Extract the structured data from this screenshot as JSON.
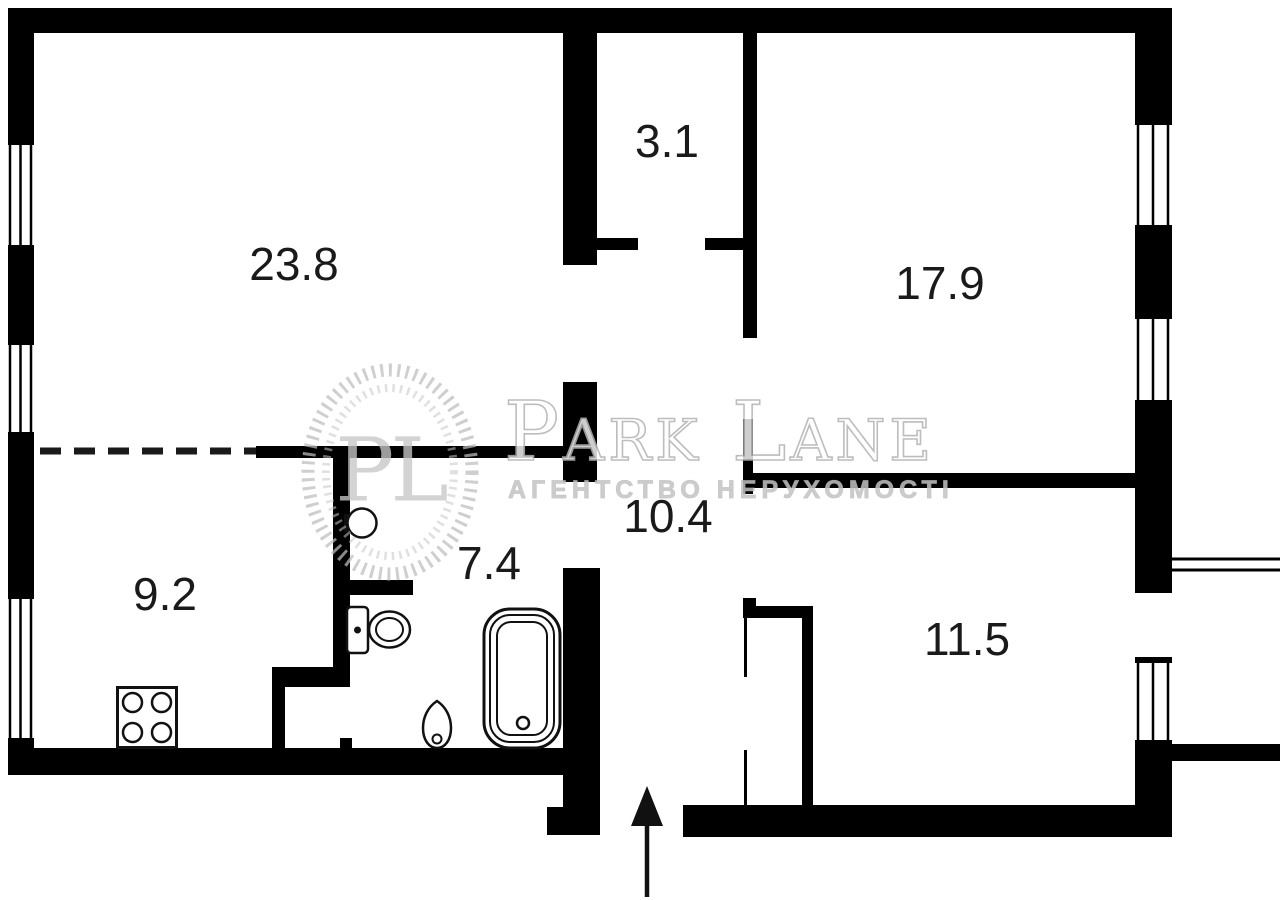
{
  "title": "apartment floor plan",
  "rooms": [
    {
      "name": "living-room",
      "area_m2": "23.8"
    },
    {
      "name": "storage",
      "area_m2": "3.1"
    },
    {
      "name": "bedroom",
      "area_m2": "17.9"
    },
    {
      "name": "hallway",
      "area_m2": "10.4"
    },
    {
      "name": "bathroom",
      "area_m2": "7.4"
    },
    {
      "name": "kitchen",
      "area_m2": "9.2"
    },
    {
      "name": "bedroom-2",
      "area_m2": "11.5"
    }
  ],
  "watermark": {
    "monogram": "PL",
    "brand": "Park Lane",
    "tagline": "АГЕНТСТВО НЕРУХОМОСТІ"
  },
  "symbols": {
    "entrance": "arrow-up",
    "window_count": 6,
    "balcony_exit": true,
    "dashed_opening": true
  },
  "fixtures": [
    "stove",
    "wash-basin",
    "toilet",
    "pedestal-sink",
    "bathtub",
    "wardrobe"
  ],
  "colors": {
    "wall": "#000000",
    "background": "#ffffff",
    "fixture_line": "#111111",
    "label_text": "#1a1a1a",
    "watermark_gray": "#c0c0c0"
  }
}
